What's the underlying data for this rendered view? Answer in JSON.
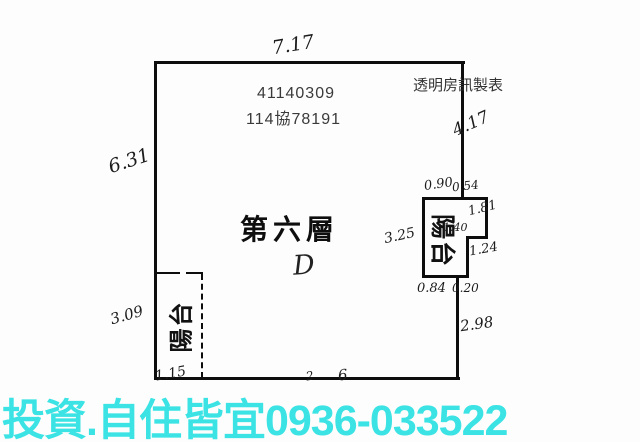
{
  "plan": {
    "title_ids": {
      "line1": "41140309",
      "line2": "114協78191"
    },
    "maker_label": "透明房訊製表",
    "floor_label": "第六層",
    "unit_label": "D",
    "balcony_left_label": "陽台",
    "balcony_right_label": "陽台",
    "dims": [
      "7.17",
      "4.17",
      "6.31",
      "3.25",
      "0.90",
      "0.54",
      "1.81",
      "1.40",
      "1.24",
      "0.84",
      "0.20",
      "2.98",
      "3.09",
      "1.15",
      "2",
      "6"
    ]
  },
  "banner": {
    "text": "投資.自住皆宜0936-033522",
    "color": "#3BE3E4"
  },
  "colors": {
    "ink": "#0d0d0d",
    "print_gray": "#3a3a3a"
  }
}
